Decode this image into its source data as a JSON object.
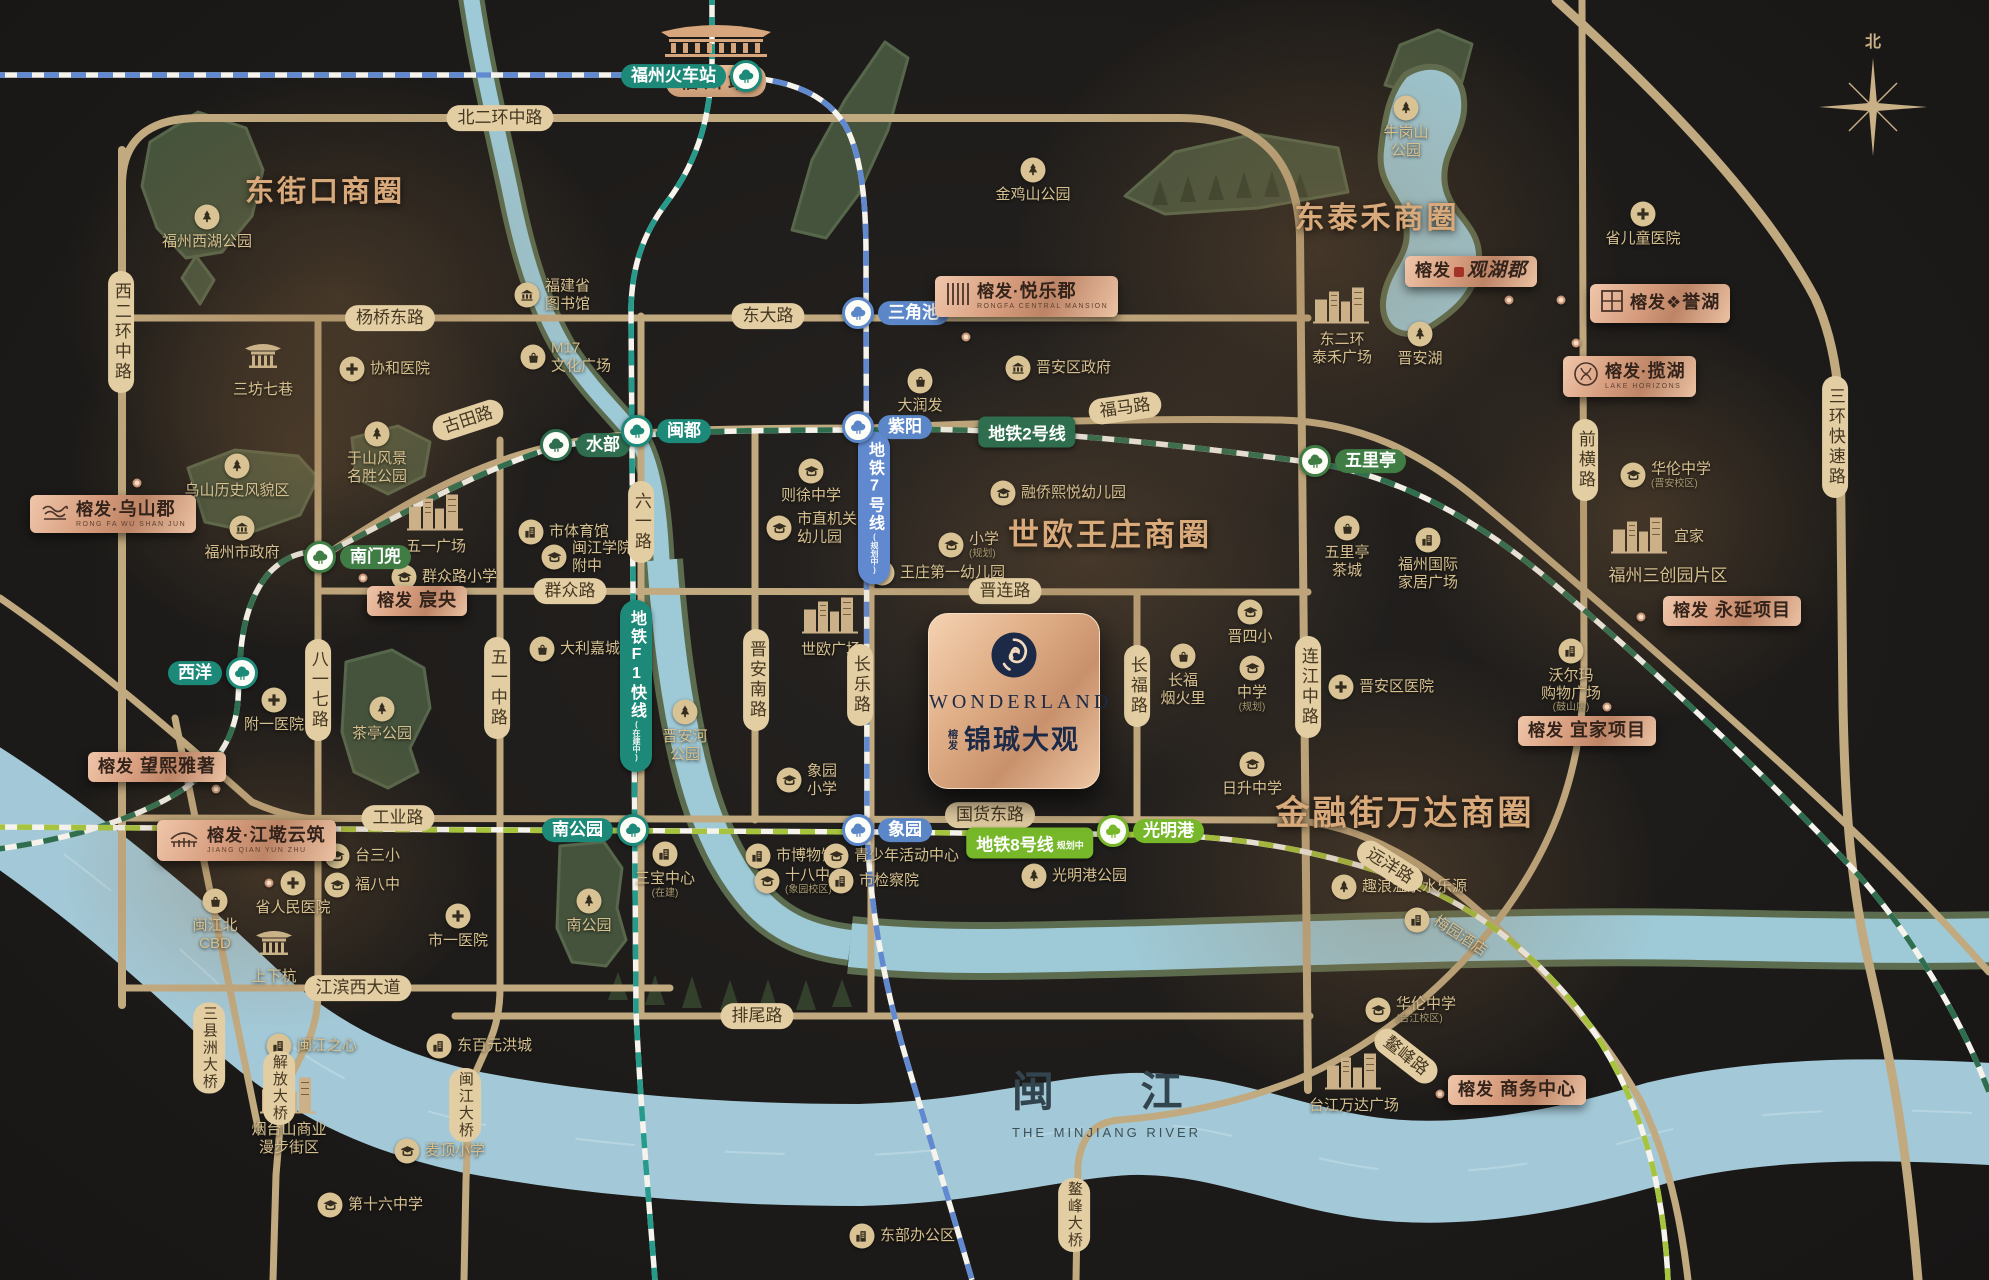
{
  "canvas": {
    "w": 1989,
    "h": 1280
  },
  "colors": {
    "bg": "#1d1b19",
    "road": "#c2aa80",
    "road_label_bg": "#e3cda2",
    "gold_title": "#d8a97a",
    "river": "#a3c9d8",
    "river_bank": "#5c6c4e",
    "park": "#45533c",
    "lake": "#9ec9d6",
    "line1_teal": "#279b8b",
    "line2_green": "#2e6e4e",
    "line7_blue": "#6189cf",
    "line8_lime": "#a6c43d",
    "lime_badge": "#76b82a",
    "badge_copper": "#d69c7d",
    "logo_navy": "#1d2a47"
  },
  "compass": {
    "north": "北"
  },
  "logo": {
    "brand": "WONDERLAND",
    "pre1": "榕",
    "pre2": "发",
    "name": "锦珹大观"
  },
  "river": {
    "cn": "闽 江",
    "en": "THE MINJIANG RIVER"
  },
  "rail_station": {
    "name": "福州站"
  },
  "glows": [
    {
      "x": 340,
      "y": 295,
      "rx": 280,
      "ry": 225
    },
    {
      "x": 1320,
      "y": 250,
      "rx": 305,
      "ry": 265
    },
    {
      "x": 1090,
      "y": 555,
      "rx": 305,
      "ry": 240
    },
    {
      "x": 1390,
      "y": 880,
      "rx": 270,
      "ry": 230
    },
    {
      "x": 1640,
      "y": 520,
      "rx": 230,
      "ry": 200
    },
    {
      "x": 300,
      "y": 460,
      "rx": 230,
      "ry": 190
    },
    {
      "x": 270,
      "y": 870,
      "rx": 215,
      "ry": 165
    }
  ],
  "business_circles": [
    {
      "t": "东街口商圈",
      "x": 325,
      "y": 189,
      "fs": 29
    },
    {
      "t": "东泰禾商圈",
      "x": 1377,
      "y": 215,
      "fs": 30
    },
    {
      "t": "世欧王庄商圈",
      "x": 1110,
      "y": 532,
      "fs": 31
    },
    {
      "t": "金融街万达商圈",
      "x": 1405,
      "y": 810,
      "fs": 34
    }
  ],
  "road_labels": [
    {
      "t": "北二环中路",
      "x": 500,
      "y": 118
    },
    {
      "t": "杨桥东路",
      "x": 390,
      "y": 318
    },
    {
      "t": "东大路",
      "x": 768,
      "y": 316
    },
    {
      "t": "古田路",
      "x": 468,
      "y": 420,
      "rot": -18
    },
    {
      "t": "福马路",
      "x": 1125,
      "y": 408,
      "rot": -8
    },
    {
      "t": "群众路",
      "x": 570,
      "y": 591
    },
    {
      "t": "晋连路",
      "x": 1005,
      "y": 591
    },
    {
      "t": "工业路",
      "x": 398,
      "y": 818
    },
    {
      "t": "国货东路",
      "x": 990,
      "y": 815
    },
    {
      "t": "远洋路",
      "x": 1390,
      "y": 866,
      "rot": 32
    },
    {
      "t": "排尾路",
      "x": 757,
      "y": 1016
    },
    {
      "t": "江滨西大道",
      "x": 358,
      "y": 988
    },
    {
      "t": "鳌峰路",
      "x": 1406,
      "y": 1056,
      "rot": 38
    },
    {
      "t": "西二环中路",
      "x": 121,
      "y": 332,
      "v": 1
    },
    {
      "t": "八一七路",
      "x": 318,
      "y": 690,
      "v": 1
    },
    {
      "t": "五一中路",
      "x": 497,
      "y": 688,
      "v": 1
    },
    {
      "t": "六一路",
      "x": 641,
      "y": 522,
      "v": 1
    },
    {
      "t": "晋安南路",
      "x": 756,
      "y": 680,
      "v": 1
    },
    {
      "t": "长乐路",
      "x": 860,
      "y": 685,
      "v": 1
    },
    {
      "t": "长福路",
      "x": 1137,
      "y": 686,
      "v": 1
    },
    {
      "t": "连江中路",
      "x": 1308,
      "y": 687,
      "v": 1
    },
    {
      "t": "前横路",
      "x": 1585,
      "y": 460,
      "v": 1
    },
    {
      "t": "三环快速路",
      "x": 1835,
      "y": 437,
      "v": 1
    },
    {
      "t": "三县洲大桥",
      "x": 209,
      "y": 1048,
      "v": 1,
      "sm": 1
    },
    {
      "t": "解放大桥",
      "x": 279,
      "y": 1088,
      "v": 1,
      "sm": 1
    },
    {
      "t": "闽江大桥",
      "x": 465,
      "y": 1105,
      "v": 1,
      "sm": 1
    },
    {
      "t": "鳌峰大桥",
      "x": 1074,
      "y": 1215,
      "v": 1,
      "sm": 1
    }
  ],
  "metro_badges": [
    {
      "t": "地铁2号线",
      "sub": "",
      "x": 1027,
      "y": 432,
      "c": "#2e6e4e"
    },
    {
      "t": "地铁8号线",
      "sub": "规划中",
      "x": 1030,
      "y": 843,
      "c": "#76b82a"
    },
    {
      "t": "地铁7号线",
      "sub": "(规划中)",
      "x": 874,
      "y": 508,
      "c": "#6189cf",
      "v": 1
    },
    {
      "t": "地铁F1快线",
      "sub": "(在建中)",
      "x": 636,
      "y": 686,
      "c": "#1d8a79",
      "v": 1
    }
  ],
  "stations": [
    {
      "n": "福州火车站",
      "x": 746,
      "y": 76,
      "c": "#1d8a79",
      "side": "l"
    },
    {
      "n": "西洋",
      "x": 242,
      "y": 673,
      "c": "#1d8a79",
      "side": "l"
    },
    {
      "n": "南门兜",
      "x": 320,
      "y": 557,
      "c": "#3f7d44",
      "side": "r"
    },
    {
      "n": "水部",
      "x": 556,
      "y": 445,
      "c": "#2e6e4e",
      "side": "r"
    },
    {
      "n": "闽都",
      "x": 637,
      "y": 431,
      "c": "#1d8a79",
      "side": "r"
    },
    {
      "n": "三角池",
      "x": 858,
      "y": 313,
      "c": "#5b87c9",
      "side": "r"
    },
    {
      "n": "紫阳",
      "x": 858,
      "y": 427,
      "c": "#5b87c9",
      "side": "r"
    },
    {
      "n": "五里亭",
      "x": 1315,
      "y": 461,
      "c": "#3f7d44",
      "side": "r"
    },
    {
      "n": "南公园",
      "x": 633,
      "y": 830,
      "c": "#1d8a79",
      "side": "l"
    },
    {
      "n": "象园",
      "x": 858,
      "y": 830,
      "c": "#5b87c9",
      "side": "r"
    },
    {
      "n": "光明港",
      "x": 1113,
      "y": 831,
      "c": "#76b82a",
      "side": "r"
    }
  ],
  "pois": [
    {
      "n": "福州西湖公园",
      "i": "tree",
      "x": 207,
      "y": 217,
      "s": "b"
    },
    {
      "n": "三坊七巷",
      "i": "temple",
      "x": 263,
      "y": 357,
      "s": "b"
    },
    {
      "n": "协和医院",
      "i": "cross",
      "x": 352,
      "y": 369,
      "s": "r"
    },
    {
      "n": "福建省\n图书馆",
      "i": "gov",
      "x": 527,
      "y": 295,
      "s": "r"
    },
    {
      "n": "M17\n文化广场",
      "i": "bag",
      "x": 533,
      "y": 357,
      "s": "r"
    },
    {
      "n": "于山风景\n名胜公园",
      "i": "tree",
      "x": 377,
      "y": 434,
      "s": "b"
    },
    {
      "n": "乌山历史风貌区",
      "i": "tree",
      "x": 237,
      "y": 466,
      "s": "b"
    },
    {
      "n": "福州市政府",
      "i": "gov",
      "x": 242,
      "y": 528,
      "s": "b"
    },
    {
      "n": "五一广场",
      "i": "bldglg",
      "x": 436,
      "y": 514,
      "s": "b"
    },
    {
      "n": "群众路小学",
      "i": "school",
      "x": 404,
      "y": 577,
      "s": "r"
    },
    {
      "n": "市体育馆",
      "i": "bldg",
      "x": 531,
      "y": 532,
      "s": "r"
    },
    {
      "n": "闽江学院\n附中",
      "i": "school",
      "x": 554,
      "y": 557,
      "s": "r"
    },
    {
      "n": "大利嘉城",
      "i": "bag",
      "x": 542,
      "y": 649,
      "s": "r"
    },
    {
      "n": "附一医院",
      "i": "cross",
      "x": 274,
      "y": 700,
      "s": "b"
    },
    {
      "n": "茶亭公园",
      "i": "tree",
      "x": 382,
      "y": 709,
      "s": "b"
    },
    {
      "n": "则徐中学",
      "i": "school",
      "x": 811,
      "y": 471,
      "s": "b"
    },
    {
      "n": "市直机关\n幼儿园",
      "i": "school",
      "x": 779,
      "y": 528,
      "s": "r"
    },
    {
      "n": "晋安区政府",
      "i": "gov",
      "x": 1018,
      "y": 368,
      "s": "r"
    },
    {
      "n": "大润发",
      "i": "bag",
      "x": 920,
      "y": 381,
      "s": "b"
    },
    {
      "n": "金鸡山公园",
      "i": "tree",
      "x": 1033,
      "y": 170,
      "s": "b"
    },
    {
      "n": "牛岗山\n公园",
      "i": "tree",
      "x": 1406,
      "y": 108,
      "s": "b"
    },
    {
      "n": "东二环\n泰禾广场",
      "i": "bldglg",
      "x": 1342,
      "y": 307,
      "s": "b"
    },
    {
      "n": "晋安湖",
      "i": "tree",
      "x": 1420,
      "y": 334,
      "s": "b"
    },
    {
      "n": "省儿童医院",
      "i": "cross",
      "x": 1643,
      "y": 214,
      "s": "b"
    },
    {
      "n": "融侨熙悦幼儿园",
      "i": "school",
      "x": 1003,
      "y": 493,
      "s": "r"
    },
    {
      "n": "小学",
      "i": "school",
      "x": 951,
      "y": 545,
      "s": "r",
      "sub": "(规划)"
    },
    {
      "n": "王庄第一幼儿园",
      "i": "school",
      "x": 882,
      "y": 573,
      "s": "r"
    },
    {
      "n": "世欧广场",
      "i": "bldglg",
      "x": 831,
      "y": 617,
      "s": "b"
    },
    {
      "n": "晋安河\n公园",
      "i": "tree",
      "x": 685,
      "y": 712,
      "s": "b"
    },
    {
      "n": "象园\n小学",
      "i": "school",
      "x": 789,
      "y": 780,
      "s": "r"
    },
    {
      "n": "华伦中学",
      "i": "school",
      "x": 1633,
      "y": 475,
      "s": "r",
      "sub": "(晋安校区)"
    },
    {
      "n": "宜家",
      "i": "bldglg",
      "x": 1640,
      "y": 537,
      "s": "r"
    },
    {
      "n": "五里亭\n茶城",
      "i": "bag",
      "x": 1347,
      "y": 528,
      "s": "b"
    },
    {
      "n": "福州国际\n家居广场",
      "i": "bldg",
      "x": 1428,
      "y": 540,
      "s": "b"
    },
    {
      "n": "晋四小",
      "i": "school",
      "x": 1250,
      "y": 612,
      "s": "b"
    },
    {
      "n": "长福\n烟火里",
      "i": "bag",
      "x": 1183,
      "y": 656,
      "s": "b"
    },
    {
      "n": "中学",
      "i": "school",
      "x": 1252,
      "y": 668,
      "s": "b",
      "sub": "(规划)"
    },
    {
      "n": "日升中学",
      "i": "school",
      "x": 1252,
      "y": 764,
      "s": "b"
    },
    {
      "n": "晋安区医院",
      "i": "cross",
      "x": 1341,
      "y": 687,
      "s": "r"
    },
    {
      "n": "沃尔玛\n购物广场",
      "i": "bldg",
      "x": 1571,
      "y": 651,
      "s": "b",
      "sub": "(鼓山店)"
    },
    {
      "n": "华伦中学",
      "i": "school",
      "x": 1378,
      "y": 1010,
      "s": "r",
      "sub": "(台江校区)"
    },
    {
      "n": "趣浪温泉水乐源",
      "i": "tree",
      "x": 1344,
      "y": 887,
      "s": "r"
    },
    {
      "n": "梅园酒店",
      "i": "bldg",
      "x": 1417,
      "y": 920,
      "s": "r",
      "rot": 33
    },
    {
      "n": "台江万达广场",
      "i": "bldglg",
      "x": 1354,
      "y": 1073,
      "s": "b"
    },
    {
      "n": "东部办公区",
      "i": "bldg",
      "x": 862,
      "y": 1236,
      "s": "r"
    },
    {
      "n": "台三小",
      "i": "school",
      "x": 337,
      "y": 856,
      "s": "r"
    },
    {
      "n": "福八中",
      "i": "school",
      "x": 337,
      "y": 885,
      "s": "r"
    },
    {
      "n": "市一医院",
      "i": "cross",
      "x": 458,
      "y": 916,
      "s": "b"
    },
    {
      "n": "省人民医院",
      "i": "cross",
      "x": 293,
      "y": 883,
      "s": "b"
    },
    {
      "n": "闽江北\nCBD",
      "i": "bag",
      "x": 215,
      "y": 901,
      "s": "b"
    },
    {
      "n": "上下杭",
      "i": "temple",
      "x": 274,
      "y": 944,
      "s": "b"
    },
    {
      "n": "闽江之心",
      "i": "bldg",
      "x": 279,
      "y": 1046,
      "s": "r"
    },
    {
      "n": "东百元洪城",
      "i": "bldg",
      "x": 439,
      "y": 1046,
      "s": "r"
    },
    {
      "n": "烟台山商业\n漫步街区",
      "i": "bldglg",
      "x": 289,
      "y": 1097,
      "s": "b"
    },
    {
      "n": "麦顶小学",
      "i": "school",
      "x": 407,
      "y": 1151,
      "s": "r"
    },
    {
      "n": "第十六中学",
      "i": "school",
      "x": 330,
      "y": 1205,
      "s": "r"
    },
    {
      "n": "市博物馆",
      "i": "bldg",
      "x": 758,
      "y": 856,
      "s": "r"
    },
    {
      "n": "十八中",
      "i": "school",
      "x": 767,
      "y": 881,
      "s": "r",
      "sub": "(象园校区)"
    },
    {
      "n": "青少年活动中心",
      "i": "school",
      "x": 836,
      "y": 856,
      "s": "r"
    },
    {
      "n": "市检察院",
      "i": "bldg",
      "x": 841,
      "y": 881,
      "s": "r"
    },
    {
      "n": "三宝中心",
      "i": "bldg",
      "x": 665,
      "y": 854,
      "s": "b",
      "sub": "(在建)"
    },
    {
      "n": "南公园",
      "i": "tree",
      "x": 589,
      "y": 901,
      "s": "b"
    },
    {
      "n": "光明港公园",
      "i": "tree",
      "x": 1034,
      "y": 876,
      "s": "r"
    }
  ],
  "texts": [
    {
      "t": "福州三创园片区",
      "x": 1668,
      "y": 576,
      "fs": 17
    }
  ],
  "projects": [
    {
      "id": "wushanjun",
      "brand": "榕发",
      "sep": "·",
      "name": "乌山郡",
      "en": "RONG FA WU SHAN JUN",
      "icon": "wave",
      "x": 30,
      "y": 495,
      "w": 124,
      "dx": 137,
      "dy": 483
    },
    {
      "id": "chenyang",
      "brand": "榕发",
      "sep": " ",
      "name": "宸央",
      "x": 367,
      "y": 586,
      "dx": 363,
      "dy": 578
    },
    {
      "id": "wangxi",
      "brand": "榕发",
      "sep": " ",
      "name": "望熙雅著",
      "x": 88,
      "y": 752,
      "dx": 216,
      "dy": 789
    },
    {
      "id": "jiangqian",
      "brand": "榕发",
      "sep": "·",
      "name": "江墘云筑",
      "en": "JIANG QIAN YUN ZHU",
      "icon": "bridge",
      "x": 157,
      "y": 820,
      "dx": 269,
      "dy": 883
    },
    {
      "id": "yuelejun",
      "brand": "榕发",
      "sep": "·",
      "name": "悦乐郡",
      "en": "RONGFA CENTRAL MANSION",
      "icon": "hatch",
      "x": 935,
      "y": 276,
      "dx": 966,
      "dy": 337
    },
    {
      "id": "guanhujun",
      "brand": "榕发",
      "sep": "",
      "name": "观湖郡",
      "script": 1,
      "seal": 1,
      "x": 1405,
      "y": 256,
      "dx": 1509,
      "dy": 300
    },
    {
      "id": "yuhu",
      "brand": "榕发",
      "sep": "❖",
      "name": "誉湖",
      "icon": "grid",
      "x": 1590,
      "y": 284,
      "dx": 1561,
      "dy": 300
    },
    {
      "id": "lanhu",
      "brand": "榕发",
      "sep": "·",
      "name": "揽湖",
      "en": "LAKE HORIZONS",
      "icon": "rings",
      "x": 1563,
      "y": 356,
      "dx": 1576,
      "dy": 343
    },
    {
      "id": "yongyan",
      "brand": "榕发",
      "sep": " ",
      "name": "永延项目",
      "x": 1663,
      "y": 596,
      "dx": 1641,
      "dy": 617
    },
    {
      "id": "yijia",
      "brand": "榕发",
      "sep": " ",
      "name": "宜家项目",
      "x": 1518,
      "y": 716,
      "dx": 1607,
      "dy": 707
    },
    {
      "id": "shangwu",
      "brand": "榕发",
      "sep": " ",
      "name": "商务中心",
      "x": 1448,
      "y": 1075,
      "dx": 1440,
      "dy": 1094
    }
  ]
}
